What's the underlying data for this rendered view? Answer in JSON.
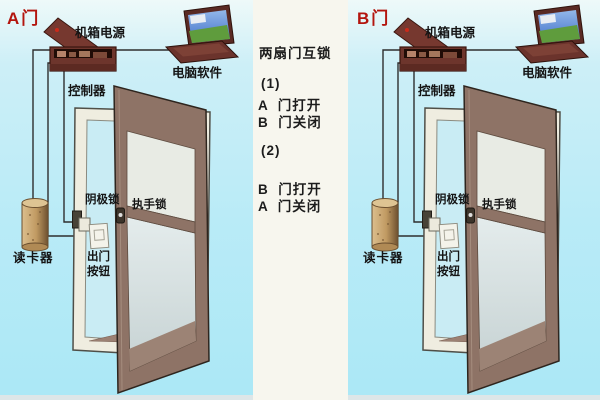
{
  "panels": [
    {
      "door_label": "A门",
      "labels": {
        "power": "机箱电源",
        "software": "电脑软件",
        "controller": "控制器",
        "cathode_lock": "阴极锁",
        "handle_lock": "执手锁",
        "reader": "读卡器",
        "exit_line1": "出门",
        "exit_line2": "按钮"
      }
    },
    {
      "door_label": "B门",
      "labels": {
        "power": "机箱电源",
        "software": "电脑软件",
        "controller": "控制器",
        "cathode_lock": "阴极锁",
        "handle_lock": "执手锁",
        "reader": "读卡器",
        "exit_line1": "出门",
        "exit_line2": "按钮"
      }
    }
  ],
  "center": {
    "title": "两扇门互锁",
    "case1": {
      "no": "(1)",
      "line1": "A  门打开",
      "line2": "B  门关闭"
    },
    "case2": {
      "no": "(2)",
      "line1": "B  门打开",
      "line2": "A  门关闭"
    }
  },
  "colors": {
    "background_cyan": "#b9ebf7",
    "center_strip": "#f7f6ee",
    "door_tag_red": "#b3150e",
    "door_brown": "#8e7366",
    "controller_box_maroon": "#6d352c",
    "card_reader_tan": "#c09a62",
    "frame_white": "#efede0"
  }
}
